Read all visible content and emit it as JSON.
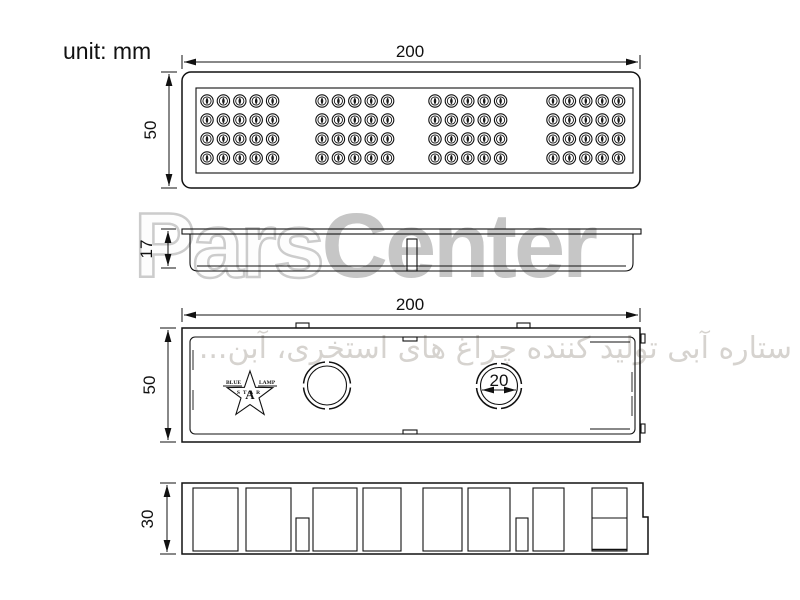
{
  "page": {
    "unit_label": "unit: mm"
  },
  "watermarks": {
    "brand_outline": "Pars",
    "brand_solid": "Center",
    "persian_text": "ستاره آبی تولید کننده چراغ های استخری، آبن..."
  },
  "colors": {
    "line": "#111111",
    "watermark_light_gray": "#c9c9c9",
    "watermark_warm_gray": "#d6d3cf"
  },
  "views": {
    "top_view": {
      "width_label": "200",
      "height_label": "50",
      "led_grid": {
        "groups": 4,
        "cols_per_group": 5,
        "rows": 4,
        "total_leds": 80,
        "group_start_x": [
          207,
          322,
          435,
          553
        ],
        "col_spacing": 16.4,
        "row_y": [
          101,
          120,
          139,
          158
        ]
      }
    },
    "side_view": {
      "height_label": "17"
    },
    "back_view": {
      "width_label": "200",
      "height_label": "50",
      "hole_diameter_label": "20",
      "logo": {
        "word_left": "BLUE",
        "word_right": "LAMP",
        "word_bottom": "STAR",
        "letter_center": "A"
      }
    },
    "bottom_view": {
      "height_label": "30"
    }
  }
}
